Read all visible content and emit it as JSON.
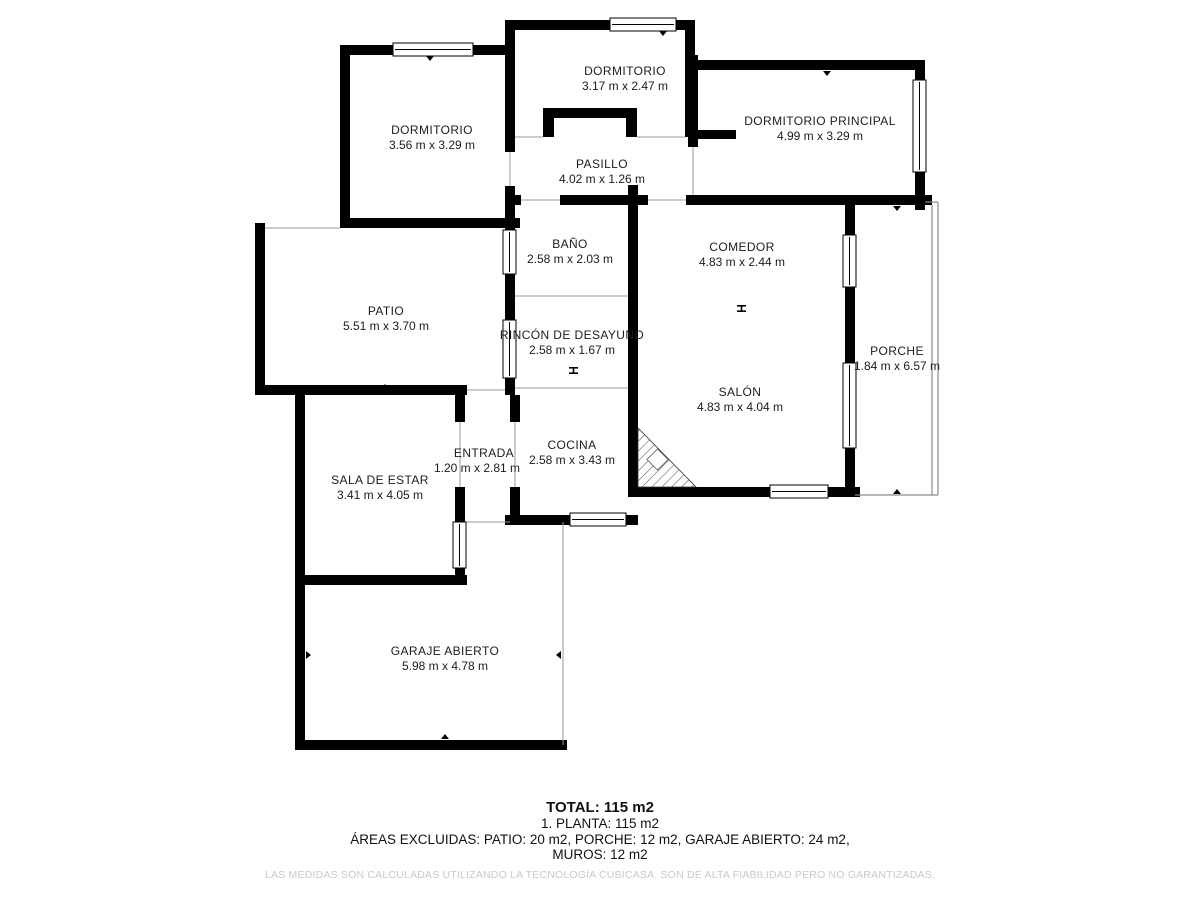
{
  "plan": {
    "title": "Plano de planta",
    "source_note": "CubiCasa"
  },
  "rooms": [
    {
      "name": "DORMITORIO",
      "dims": "3.56 m x 3.29 m"
    },
    {
      "name": "DORMITORIO",
      "dims": "3.17 m x 2.47 m"
    },
    {
      "name": "DORMITORIO PRINCIPAL",
      "dims": "4.99 m x 3.29 m"
    },
    {
      "name": "PASILLO",
      "dims": "4.02 m x 1.26 m"
    },
    {
      "name": "BAÑO",
      "dims": "2.58 m x 2.03 m"
    },
    {
      "name": "COMEDOR",
      "dims": "4.83 m x 2.44 m"
    },
    {
      "name": "PATIO",
      "dims": "5.51 m x 3.70 m"
    },
    {
      "name": "RINCÓN DE DESAYUNO",
      "dims": "2.58 m x 1.67 m"
    },
    {
      "name": "PORCHE",
      "dims": "1.84 m x 6.57 m"
    },
    {
      "name": "SALÓN",
      "dims": "4.83 m x 4.04 m"
    },
    {
      "name": "ENTRADA",
      "dims": "1.20 m x 2.81 m"
    },
    {
      "name": "COCINA",
      "dims": "2.58 m x 3.43 m"
    },
    {
      "name": "SALA DE ESTAR",
      "dims": "3.41 m x 4.05 m"
    },
    {
      "name": "GARAJE ABIERTO",
      "dims": "5.98 m x 4.78 m"
    }
  ],
  "summary": {
    "total": "TOTAL: 115 m2",
    "floor": "1. PLANTA: 115 m2",
    "excluded": "ÁREAS EXCLUIDAS: PATIO: 20 m2, PORCHE: 12 m2, GARAJE ABIERTO: 24 m2,",
    "walls": "MUROS: 12 m2"
  },
  "disclaimer": "LAS MEDIDAS SON CALCULADAS UTILIZANDO LA TECNOLOGÍA CUBICASA. SON DE ALTA FIABILIDAD PERO NO GARANTIZADAS.",
  "colors": {
    "wall": "#000000",
    "window_fill": "#ffffff",
    "open_boundary": "#9a9a9a",
    "text": "#1c1c1c",
    "disclaimer_text": "#c9c9c9"
  }
}
